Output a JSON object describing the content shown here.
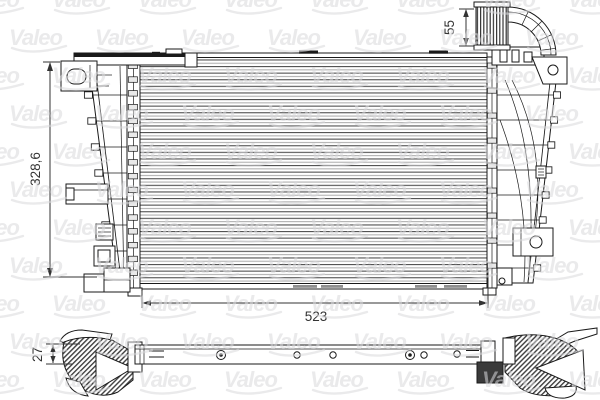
{
  "brand": {
    "watermark_text": "Valeo",
    "watermark_color": "#d9d9dc"
  },
  "colors": {
    "background": "#ffffff",
    "line": "#1a1a1a",
    "dim": "#333333",
    "fin_dark": "#4f4f4f",
    "fin_light": "#b0b0b0",
    "slot": "#8f8f8f",
    "rung": "#e9e9e9",
    "dark_block": "#3a3a3a",
    "watermark": "#d9d9dc"
  },
  "dimensions": {
    "overall_height": {
      "label": "328,6"
    },
    "inlet_duct": {
      "label": "55"
    },
    "overall_width": {
      "label": "523"
    },
    "core_depth": {
      "label": "27"
    }
  }
}
